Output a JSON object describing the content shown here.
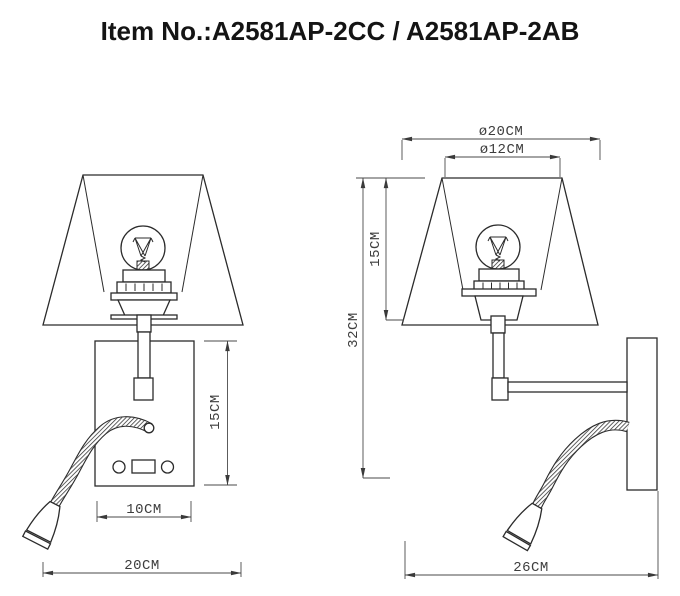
{
  "title": "Item No.:A2581AP-2CC / A2581AP-2AB",
  "item_numbers": [
    "A2581AP-2CC",
    "A2581AP-2AB"
  ],
  "front_view": {
    "plate_height": "15CM",
    "plate_width": "10CM",
    "overall_width": "20CM"
  },
  "side_view": {
    "shade_bottom_diameter": "ø20CM",
    "shade_top_diameter": "ø12CM",
    "overall_height": "32CM",
    "shade_height": "15CM",
    "overall_depth": "26CM"
  },
  "colors": {
    "line": "#2b2b2b",
    "dimension": "#4a4a4a",
    "background": "#ffffff"
  }
}
